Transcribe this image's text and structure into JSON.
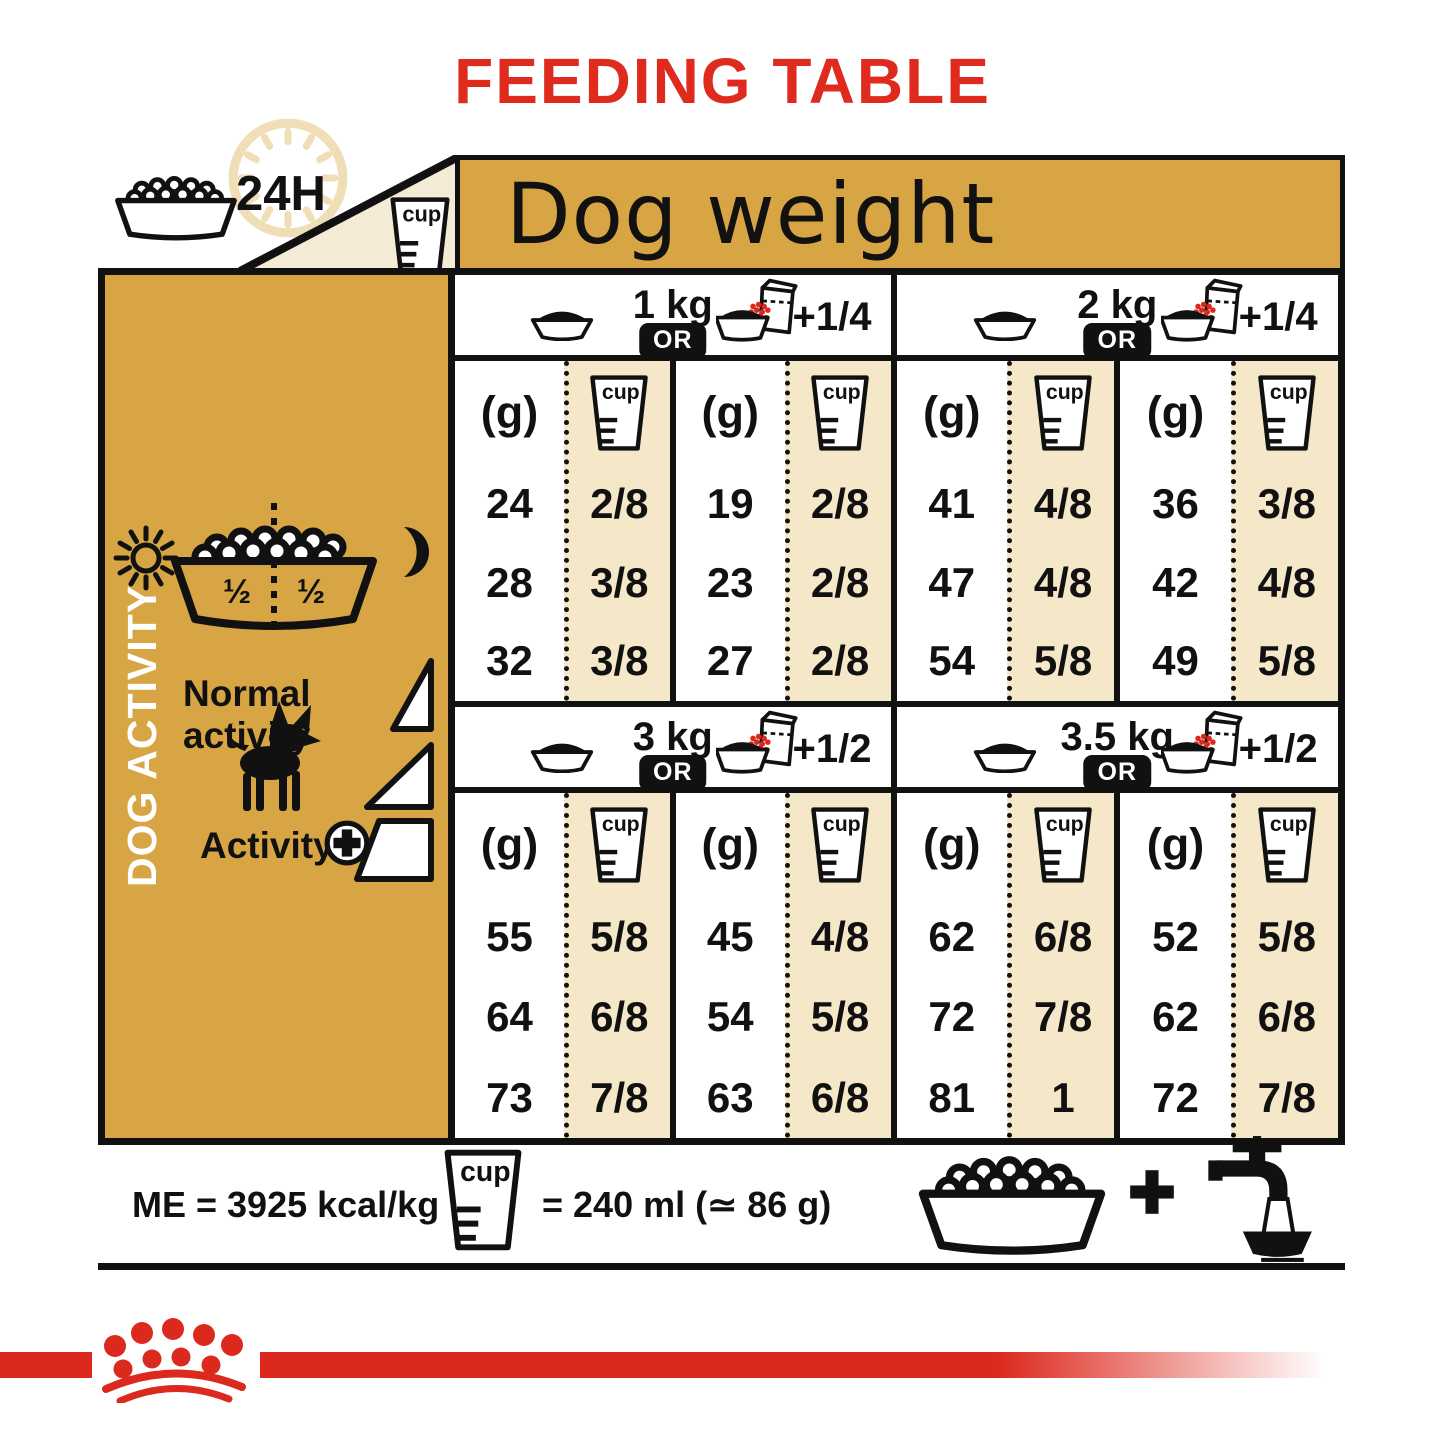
{
  "title": "FEEDING TABLE",
  "banner": {
    "dog_weight": "Dog weight",
    "h24": "24H"
  },
  "cup_label": "cup",
  "g_label": "(g)",
  "or_label": "OR",
  "sidebar": {
    "dog_activity": "DOG ACTIVITY",
    "normal_activity": "Normal activity",
    "activity": "Activity",
    "half_left": "½",
    "half_right": "½"
  },
  "sections": [
    {
      "weight": "1 kg",
      "extra": "+1/4",
      "rows": [
        [
          "24",
          "2/8",
          "19",
          "2/8"
        ],
        [
          "28",
          "3/8",
          "23",
          "2/8"
        ],
        [
          "32",
          "3/8",
          "27",
          "2/8"
        ]
      ]
    },
    {
      "weight": "2 kg",
      "extra": "+1/4",
      "rows": [
        [
          "41",
          "4/8",
          "36",
          "3/8"
        ],
        [
          "47",
          "4/8",
          "42",
          "4/8"
        ],
        [
          "54",
          "5/8",
          "49",
          "5/8"
        ]
      ]
    },
    {
      "weight": "3 kg",
      "extra": "+1/2",
      "rows": [
        [
          "55",
          "5/8",
          "45",
          "4/8"
        ],
        [
          "64",
          "6/8",
          "54",
          "5/8"
        ],
        [
          "73",
          "7/8",
          "63",
          "6/8"
        ]
      ]
    },
    {
      "weight": "3.5 kg",
      "extra": "+1/2",
      "rows": [
        [
          "62",
          "6/8",
          "52",
          "5/8"
        ],
        [
          "72",
          "7/8",
          "62",
          "6/8"
        ],
        [
          "81",
          "1",
          "72",
          "7/8"
        ]
      ]
    }
  ],
  "footer": {
    "me": "ME = 3925 kcal/kg",
    "equiv": "= 240 ml (≃ 86 g)"
  },
  "colors": {
    "gold": "#D8A544",
    "cream": "#F5E8C9",
    "red": "#DC291E",
    "black": "#111111"
  }
}
